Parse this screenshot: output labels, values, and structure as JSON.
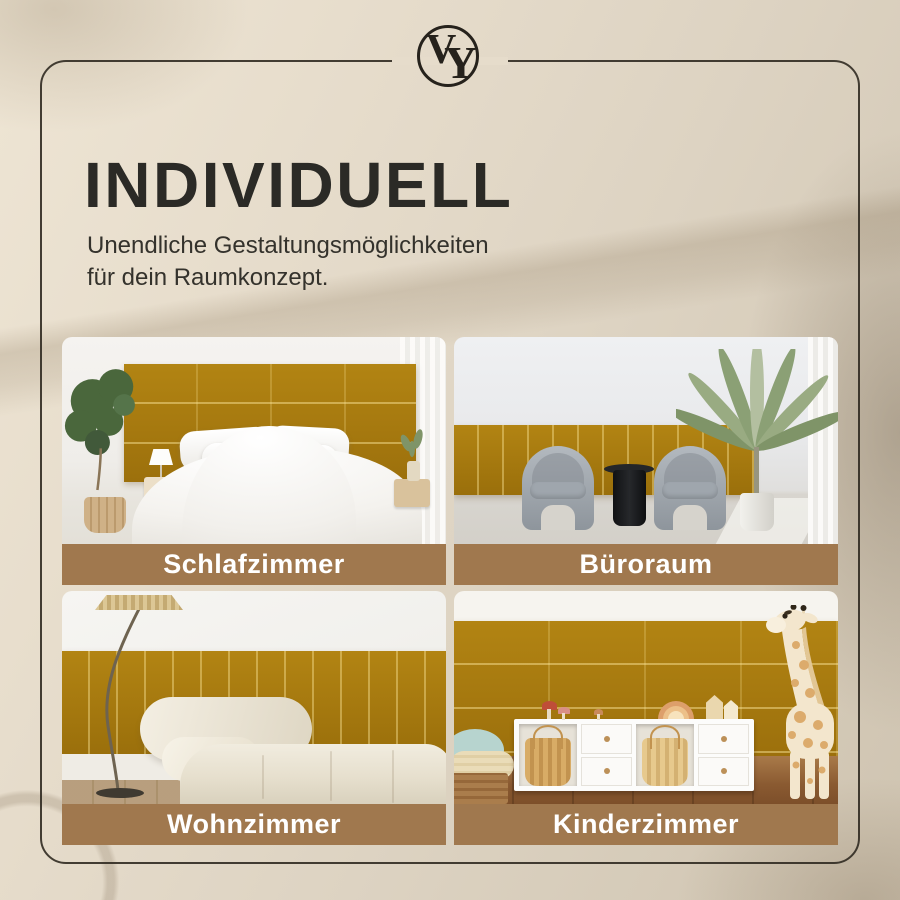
{
  "brand": {
    "logo_monogram_v": "V",
    "logo_monogram_y": "Y"
  },
  "header": {
    "title": "INDIVIDUELL",
    "subtitle_line1": "Unendliche Gestaltungsmöglichkeiten",
    "subtitle_line2": "für dein Raumkonzept."
  },
  "grid": {
    "cards": [
      {
        "label": "Schlafzimmer"
      },
      {
        "label": "Büroraum"
      },
      {
        "label": "Wohnzimmer"
      },
      {
        "label": "Kinderzimmer"
      }
    ]
  },
  "colors": {
    "background_beige": "#e6dccb",
    "frame_border": "#302a21",
    "caption_bar_brown": "#a0784e",
    "caption_text": "#ffffff",
    "panel_gold": "#a6790f",
    "heading_text": "#2b2a26"
  }
}
